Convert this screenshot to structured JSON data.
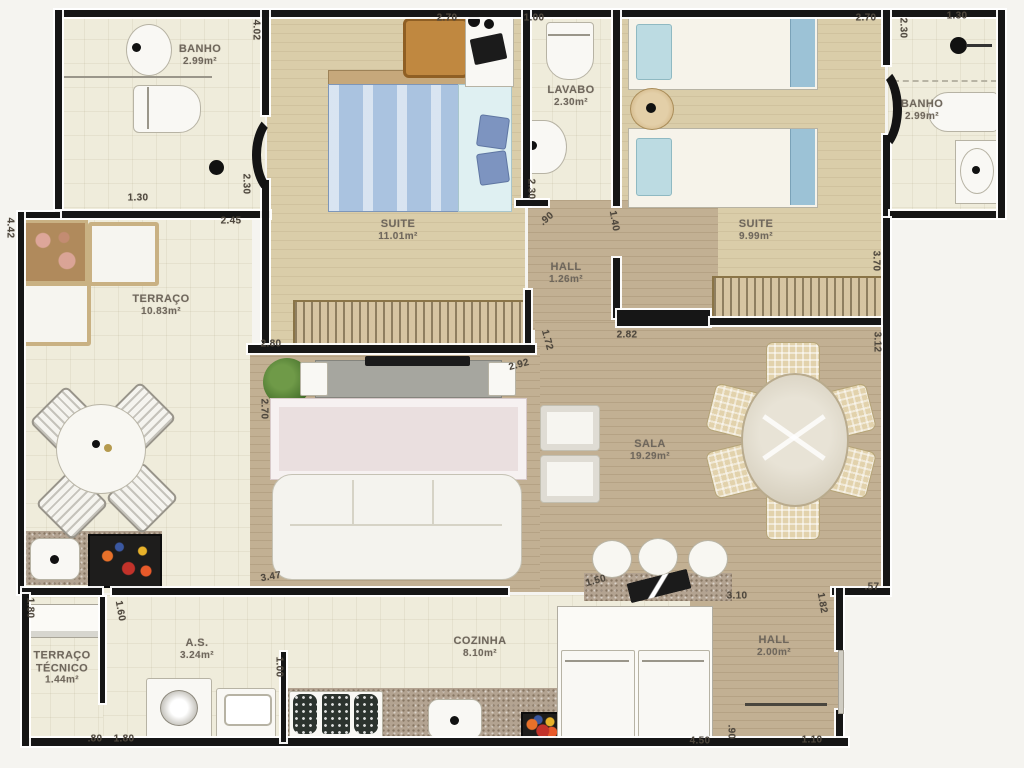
{
  "plan": {
    "title": "apartment-floor-plan",
    "colors": {
      "wall": "#161616",
      "wood_light": "#dacda9",
      "wood_dark": "#c2b093",
      "tile": "#efecdb",
      "granite": "#b3a391",
      "bed_blue": "#aac3e0",
      "wardrobe_tan": "#c9b183",
      "label_text": "#6f675c",
      "dim_text": "#4e473d"
    },
    "rooms": [
      {
        "id": "banho-esq",
        "name": "BANHO",
        "area": "2.99m²",
        "x": 200,
        "y": 55
      },
      {
        "id": "suite-1",
        "name": "SUITE",
        "area": "11.01m²",
        "x": 398,
        "y": 230
      },
      {
        "id": "lavabo",
        "name": "LAVABO",
        "area": "2.30m²",
        "x": 571,
        "y": 96
      },
      {
        "id": "suite-2",
        "name": "SUITE",
        "area": "9.99m²",
        "x": 756,
        "y": 230
      },
      {
        "id": "banho-dir",
        "name": "BANHO",
        "area": "2.99m²",
        "x": 922,
        "y": 110
      },
      {
        "id": "terraco",
        "name": "TERRAÇO",
        "area": "10.83m²",
        "x": 161,
        "y": 305
      },
      {
        "id": "hall-intimo",
        "name": "HALL",
        "area": "1.26m²",
        "x": 566,
        "y": 273
      },
      {
        "id": "sala",
        "name": "SALA",
        "area": "19.29m²",
        "x": 650,
        "y": 450
      },
      {
        "id": "terraco-tecnico",
        "name": "TERRAÇO\nTÉCNICO",
        "area": "1.44m²",
        "x": 62,
        "y": 668
      },
      {
        "id": "as",
        "name": "A.S.",
        "area": "3.24m²",
        "x": 197,
        "y": 649
      },
      {
        "id": "cozinha",
        "name": "COZINHA",
        "area": "8.10m²",
        "x": 480,
        "y": 647
      },
      {
        "id": "hall-entrada",
        "name": "HALL",
        "area": "2.00m²",
        "x": 774,
        "y": 646
      }
    ],
    "dimensions": [
      {
        "v": "2.70",
        "x": 447,
        "y": 18,
        "r": 0
      },
      {
        "v": "1.00",
        "x": 534,
        "y": 18,
        "r": 0
      },
      {
        "v": "2.70",
        "x": 866,
        "y": 18,
        "r": 0
      },
      {
        "v": "2.30",
        "x": 903,
        "y": 28,
        "r": 90
      },
      {
        "v": "1.30",
        "x": 957,
        "y": 16,
        "r": 0
      },
      {
        "v": "4.02",
        "x": 256,
        "y": 30,
        "r": 90
      },
      {
        "v": "2.30",
        "x": 246,
        "y": 184,
        "r": 90
      },
      {
        "v": "1.30",
        "x": 138,
        "y": 198,
        "r": 0
      },
      {
        "v": "2.45",
        "x": 231,
        "y": 221,
        "r": 0
      },
      {
        "v": "4.42",
        "x": 10,
        "y": 228,
        "r": 90
      },
      {
        "v": "2.30",
        "x": 531,
        "y": 189,
        "r": 90
      },
      {
        "v": ".90",
        "x": 547,
        "y": 219,
        "r": -40
      },
      {
        "v": "1.40",
        "x": 614,
        "y": 221,
        "r": 80
      },
      {
        "v": "3.70",
        "x": 876,
        "y": 261,
        "r": 90
      },
      {
        "v": "3.12",
        "x": 877,
        "y": 342,
        "r": 90
      },
      {
        "v": "2.80",
        "x": 271,
        "y": 344,
        "r": 0
      },
      {
        "v": "2.70",
        "x": 264,
        "y": 409,
        "r": 90
      },
      {
        "v": "3.47",
        "x": 271,
        "y": 577,
        "r": -10
      },
      {
        "v": "2.92",
        "x": 519,
        "y": 365,
        "r": -15
      },
      {
        "v": "1.72",
        "x": 547,
        "y": 340,
        "r": 75
      },
      {
        "v": "2.82",
        "x": 627,
        "y": 335,
        "r": 0
      },
      {
        "v": "1.50",
        "x": 596,
        "y": 581,
        "r": -15
      },
      {
        "v": "3.10",
        "x": 737,
        "y": 596,
        "r": 0
      },
      {
        "v": ".57",
        "x": 872,
        "y": 587,
        "r": 0
      },
      {
        "v": "1.82",
        "x": 822,
        "y": 603,
        "r": 80
      },
      {
        "v": "1.80",
        "x": 30,
        "y": 608,
        "r": 90
      },
      {
        "v": "1.60",
        "x": 120,
        "y": 611,
        "r": 80
      },
      {
        "v": ".80",
        "x": 95,
        "y": 739,
        "r": 0
      },
      {
        "v": "1.80",
        "x": 124,
        "y": 739,
        "r": 0
      },
      {
        "v": "1.00",
        "x": 279,
        "y": 667,
        "r": 90
      },
      {
        "v": "4.50",
        "x": 700,
        "y": 741,
        "r": 0
      },
      {
        "v": ".90",
        "x": 731,
        "y": 732,
        "r": 90
      },
      {
        "v": "1.10",
        "x": 812,
        "y": 740,
        "r": 0
      }
    ]
  }
}
